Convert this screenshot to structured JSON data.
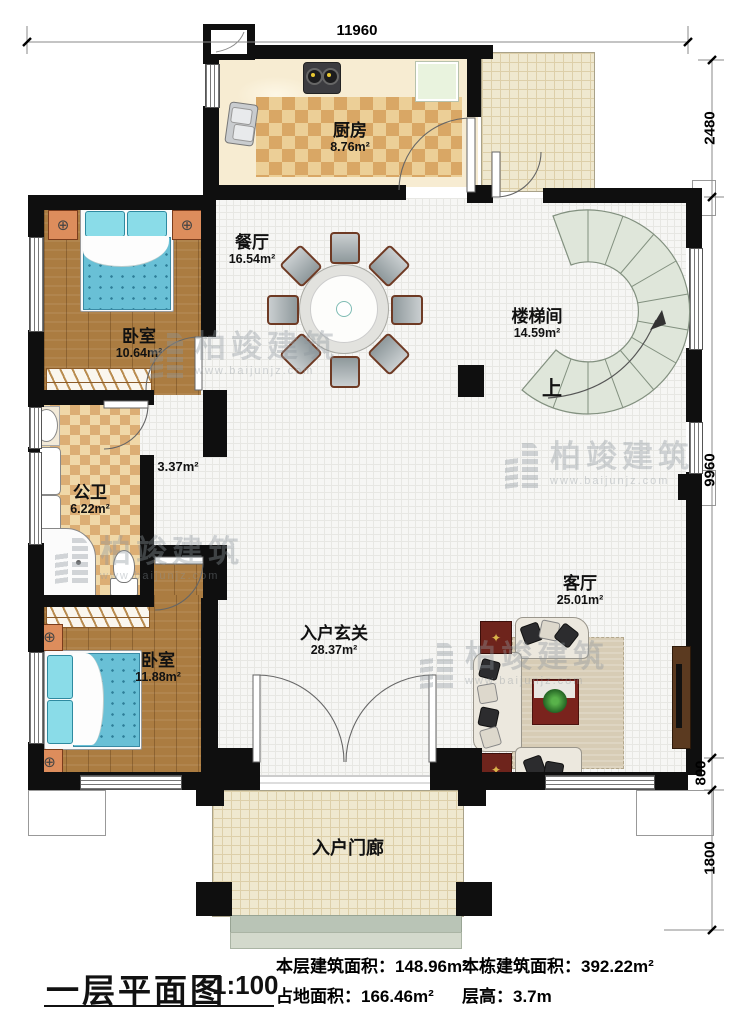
{
  "footer": {
    "title": "一层平面图",
    "scale": "1:100",
    "stats_left": [
      {
        "label": "本层建筑面积：",
        "value": "148.96m²"
      },
      {
        "label": "占地面积：",
        "value": "166.46m²"
      }
    ],
    "stats_right": [
      {
        "label": "本栋建筑面积：",
        "value": "392.22m²"
      },
      {
        "label": "层高：",
        "value": "3.7m"
      }
    ]
  },
  "dimensions": {
    "top": "11960",
    "right": [
      "2480",
      "9960",
      "800",
      "1800"
    ]
  },
  "rooms": {
    "kitchen": {
      "name": "厨房",
      "area": "8.76m²"
    },
    "dining": {
      "name": "餐厅",
      "area": "16.54m²"
    },
    "bedroom1": {
      "name": "卧室",
      "area": "10.64m²"
    },
    "stair": {
      "name": "楼梯间",
      "area": "14.59m²",
      "up": "上"
    },
    "bath": {
      "name": "公卫",
      "area": "6.22m²"
    },
    "corridor": {
      "area": "3.37m²"
    },
    "bedroom2": {
      "name": "卧室",
      "area": "11.88m²"
    },
    "foyer": {
      "name": "入户玄关",
      "area": "28.37m²"
    },
    "living": {
      "name": "客厅",
      "area": "25.01m²"
    },
    "porch": {
      "name": "入户门廊"
    }
  },
  "watermark": {
    "brand": "柏竣建筑",
    "url": "www.baijunjz.com"
  }
}
